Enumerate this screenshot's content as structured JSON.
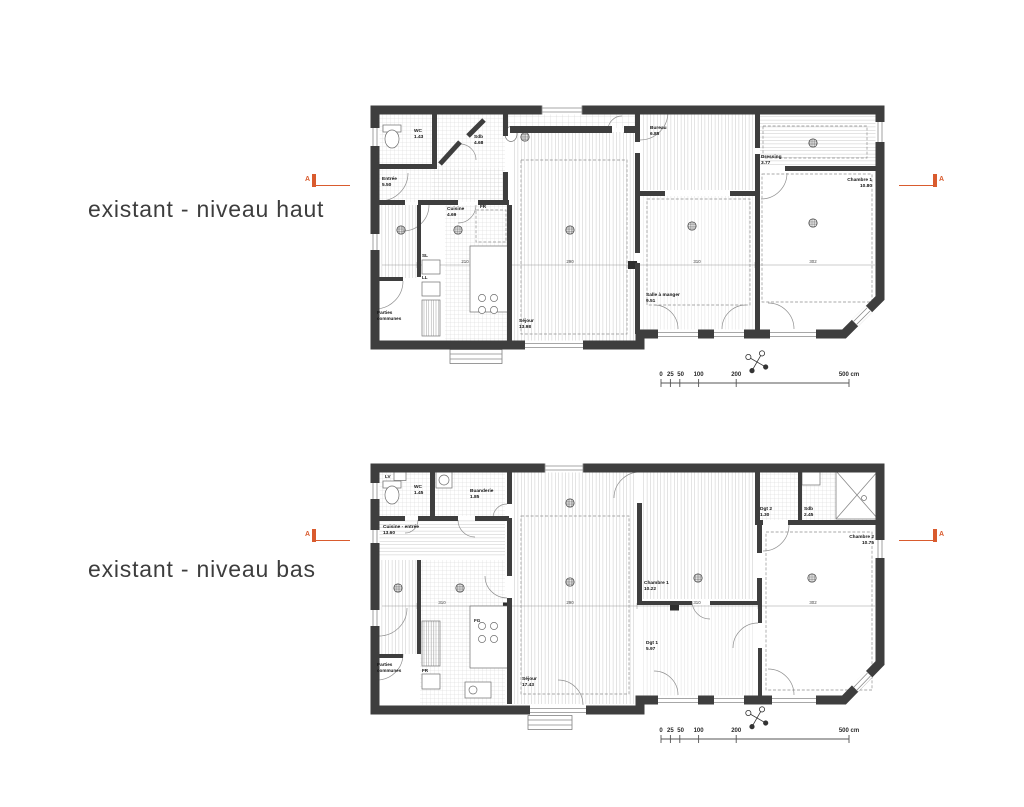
{
  "colors": {
    "accent": "#d95b2e",
    "wall": "#3e3e3e"
  },
  "section_label": "A",
  "scale": {
    "ticks": [
      "0",
      "25",
      "50",
      "100",
      "200",
      "500 cm"
    ]
  },
  "haut": {
    "title": "existant - niveau haut",
    "rooms": {
      "wc": {
        "name": "WC",
        "area": "1.43"
      },
      "entree": {
        "name": "Entrée",
        "area": "5.50"
      },
      "sdb": {
        "name": "Sdb",
        "area": "4.68"
      },
      "cuisine": {
        "name": "Cuisine",
        "area": "4.69"
      },
      "sejour": {
        "name": "Séjour",
        "area": "13.98"
      },
      "bureau": {
        "name": "Bureau",
        "area": "6.85"
      },
      "salle_a_manger": {
        "name": "Salle à manger",
        "area": "9.51"
      },
      "dressing": {
        "name": "Dressing",
        "area": "3.77"
      },
      "chambre1": {
        "name": "Chambre 1",
        "area": "10.80"
      }
    },
    "annotations": {
      "parties1": "Parties",
      "parties2": "communes",
      "fr": "FR",
      "sl": "SL",
      "ll": "LL"
    },
    "dims": {
      "d1": "210",
      "d2": "290",
      "d3": "310",
      "d4": "302"
    }
  },
  "bas": {
    "title": "existant - niveau bas",
    "rooms": {
      "wc": {
        "name": "WC",
        "area": "1.45"
      },
      "buanderie": {
        "name": "Buanderie",
        "area": "1.85"
      },
      "cuisine_entree": {
        "name": "Cuisine - entrée",
        "area": "13.60"
      },
      "sejour": {
        "name": "Séjour",
        "area": "17.43"
      },
      "chambre1": {
        "name": "Chambre 1",
        "area": "10.22"
      },
      "dgt1": {
        "name": "Dgt 1",
        "area": "5.97"
      },
      "dgt2": {
        "name": "Dgt 2",
        "area": "1.30"
      },
      "sdb": {
        "name": "Sdb",
        "area": "2.45"
      },
      "chambre2": {
        "name": "Chambre 2",
        "area": "10.75"
      }
    },
    "annotations": {
      "parties1": "Parties",
      "parties2": "communes",
      "fr": "FR",
      "fg": "FG",
      "lv": "LV"
    },
    "dims": {
      "d1": "310",
      "d2": "290",
      "d3": "310",
      "d4": "302"
    }
  }
}
